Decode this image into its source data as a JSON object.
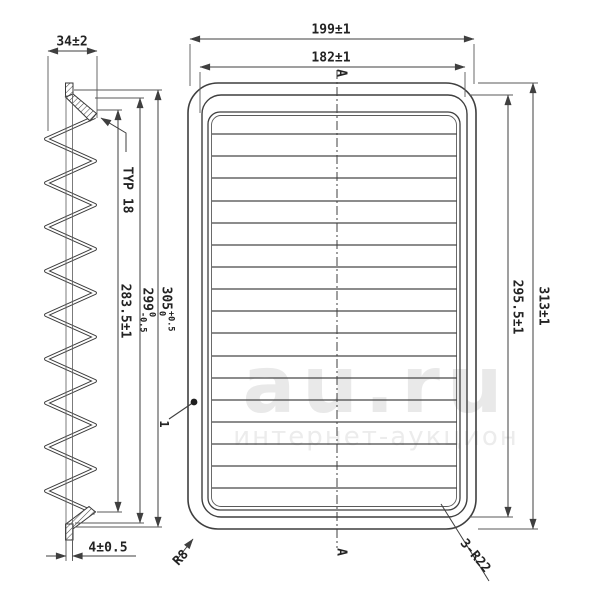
{
  "watermark": {
    "main": "au.ru",
    "sub": "интернет-аукцион"
  },
  "side_view": {
    "width_dim": "34±2",
    "pleat_label": "TYP 18",
    "pleat_height_dim": "283.5±1",
    "inner_height": {
      "base": "299",
      "tol_upper": "0",
      "tol_lower": "-0.5"
    },
    "outer_height": {
      "base": "305",
      "tol_upper": "+0.5",
      "tol_lower": "0"
    },
    "end_cap_dim": "4±0.5"
  },
  "plan_view": {
    "outer_width_dim": "199±1",
    "inner_width_dim": "182±1",
    "outer_height_dim": "313±1",
    "inner_height_dim": "295.5±1",
    "corner_radius_small": "R8",
    "corner_radius_large": "3-R22",
    "section_marker_top": "A",
    "section_marker_bottom": "A",
    "item_label": "1"
  },
  "colors": {
    "line": "#3f3f3f",
    "thin_line": "#5a5a5a",
    "text": "#232323",
    "watermark": "#e9e9e9"
  }
}
